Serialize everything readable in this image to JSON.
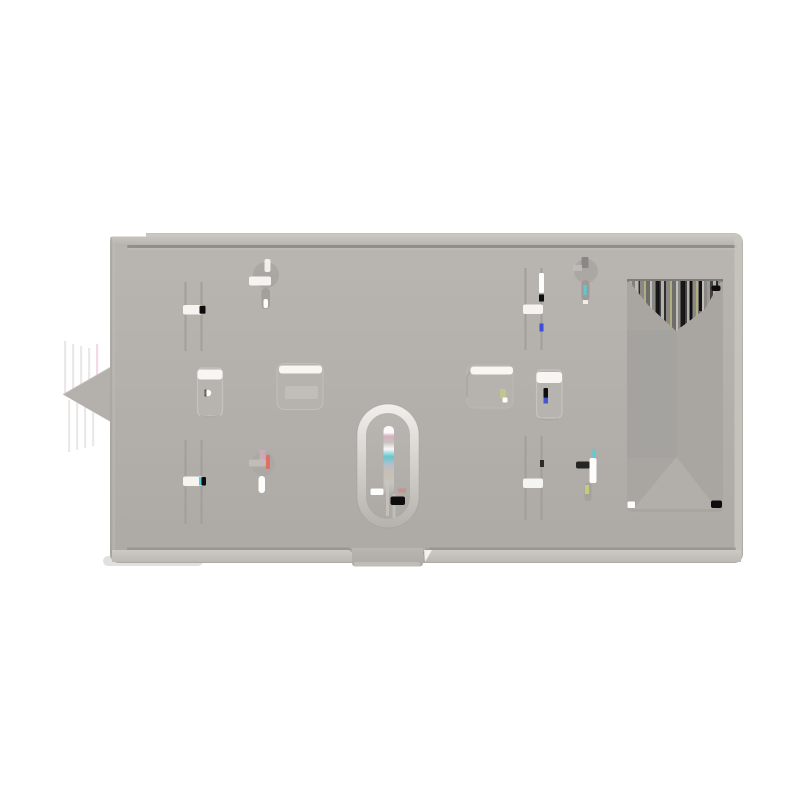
{
  "scene": {
    "type": "product-photo",
    "subject": "light gray rectangular metal mounting plate viewed front-on",
    "background": "#ffffff"
  },
  "colors": {
    "background": "#ffffff",
    "face_light": "#b9b5b1",
    "face_dark": "#ada9a5",
    "top_band_light": "#cdcac5",
    "top_band_dark": "#b4b0ac",
    "groove_dark": "#8a8783",
    "groove_soft": "#c2bfba",
    "bottom_band_light": "#cdcac6",
    "bottom_band_dark": "#bcb9b4",
    "edge_highlight": "#c8c5c0",
    "edge_shade": "#a39f9b",
    "tab_fill": "#c0bdb8",
    "wing_fill": "#b4b0ac",
    "wing_edge": "#c3c0bc",
    "slider_groove": "#a29f9b",
    "slot_white": "#f6f4f1",
    "boss_fill": "#b7b3af",
    "boss_outline": "#c6c3bf",
    "recess_fill": "#b6b2ae",
    "recess_band": "#c2bfbb",
    "highlight_white": "#f8f6f3",
    "keyhole_shade": "#a8a4a0",
    "keyhole_slot": "#9e9b97",
    "ring_light": "#f2f0ed",
    "ring_mid": "#d6d3cf",
    "ring_base": "#b5b2ae",
    "slot_blue_gray": "#b7c0cc",
    "slot_tan": "#c9c0b2",
    "cutout_fill": "#a9a6a2",
    "cutout_dark": "#a3a09c",
    "cutout_top_line": "#787673",
    "cutout_triangle": "#b2afab",
    "stripe_a": "#9b9995",
    "stripe_b": "#454442",
    "stripe_c": "#b5b3af",
    "stripe_d": "#2f2e2d",
    "stripe_e": "#8a8885",
    "stripe_olive": "#b0ae7e",
    "stripe_f": "#6f6d6a",
    "stripe_g": "#c0beba",
    "mark_black": "#0d0d0d",
    "mark_white": "#fdfdfc",
    "mark_blue": "#3344dd",
    "mark_cyan": "#55cdd6",
    "mark_red": "#e4695f",
    "mark_yellow": "#cfd077",
    "mark_pink": "#e2aec6",
    "artifact_stripe": "#dbd8d4",
    "shadow": "#b5b2ae"
  }
}
